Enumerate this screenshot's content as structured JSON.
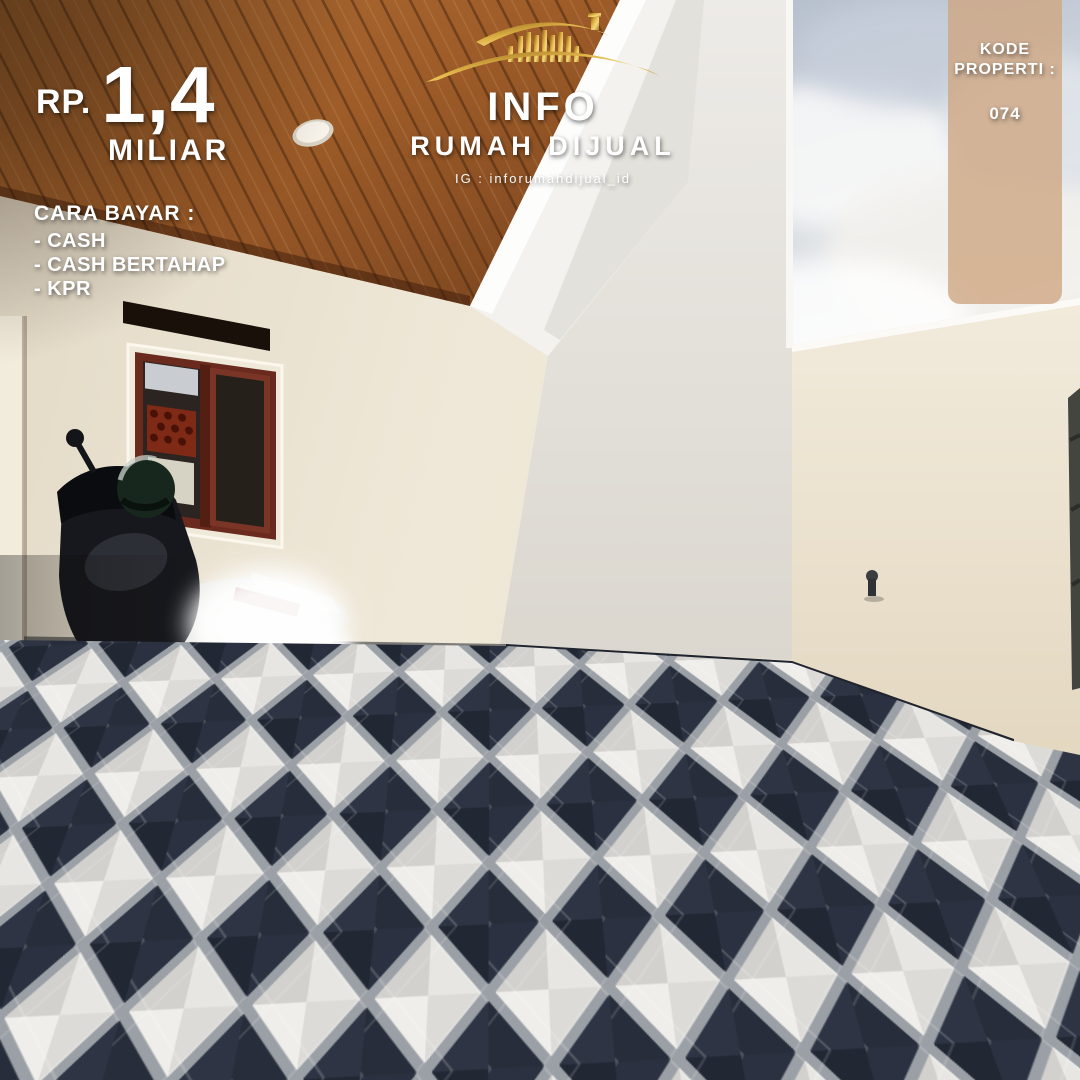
{
  "flyer": {
    "price": {
      "currency": "RP.",
      "amount": "1,4",
      "unit": "MILIAR"
    },
    "payment": {
      "heading": "CARA BAYAR :",
      "options": [
        "- CASH",
        "- CASH BERTAHAP",
        "- KPR"
      ]
    },
    "brand": {
      "name": "INFO",
      "tagline": "RUMAH DIJUAL",
      "instagram": "IG : inforumahdijual_id"
    },
    "property_code": {
      "label_line1": "KODE",
      "label_line2": "PROPERTI :",
      "code": "074"
    },
    "location": {
      "line1": "CIRACAS",
      "line2": "JAKARTA TIMUR"
    },
    "contact": {
      "heading": "INFORMASI DAN SURVEY :",
      "phone": "+62 821 91111 711"
    }
  },
  "icons": {
    "brand_icon": "gold-house-roof-icon",
    "contact_icon": "whatsapp-icon"
  },
  "colors": {
    "logo_gold": "#d9ab3c",
    "banner_tan": "#ae8157",
    "whatsapp_green": "#2ecc46",
    "code_panel_tan": "#cfa684",
    "wood_ceiling": "#a2602c",
    "tile_dark": "#2a3040",
    "tile_gray": "#9ba0a6",
    "tile_light": "#e7e6e2",
    "sky": "#c3ccd8",
    "wall_cream": "#ebe3d1"
  }
}
